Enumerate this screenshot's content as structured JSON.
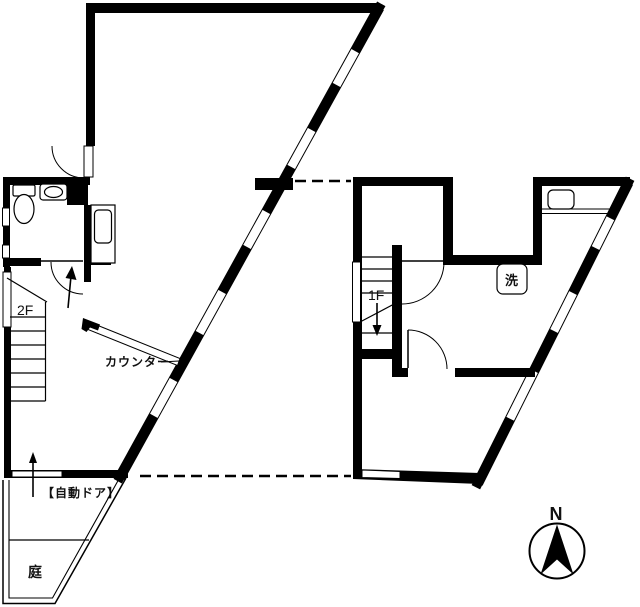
{
  "plan": {
    "type": "floor-plan",
    "labels": {
      "upper_floor": "2F",
      "lower_floor": "1F",
      "counter": "カウンター",
      "automatic_door": "【自動ドア】",
      "garden": "庭",
      "laundry": "洗",
      "north": "N"
    },
    "colors": {
      "wall": "#000000",
      "background": "#ffffff",
      "north_letter": "#3a3a42"
    },
    "icons": {
      "toilet": "toilet-icon",
      "hand_sink": "hand-sink-icon",
      "kitchen_sink": "kitchen-sink-icon",
      "washing_machine": "washing-machine-icon",
      "north_arrow": "north-arrow-icon",
      "stairs_up_arrow": "up-arrow-icon",
      "stairs_down_arrow": "down-arrow-icon",
      "auto_door_arrow": "auto-door-arrow-icon"
    }
  }
}
